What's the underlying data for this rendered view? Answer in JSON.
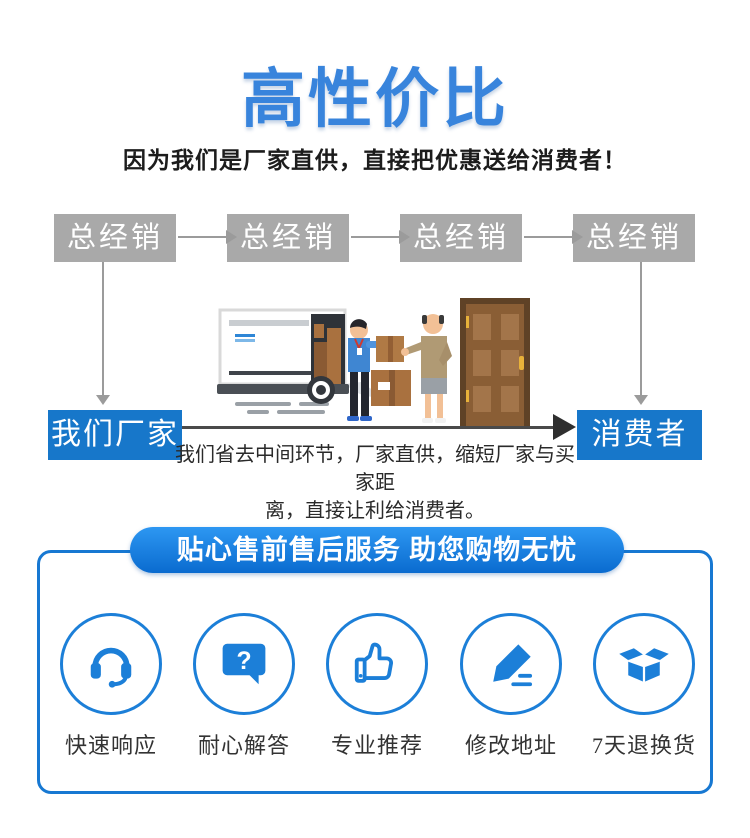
{
  "page": {
    "title": "高性价比",
    "subtitle": "因为我们是厂家直供，直接把优惠送给消费者！"
  },
  "flow": {
    "distributors": [
      "总经销",
      "总经销",
      "总经销",
      "总经销"
    ],
    "factory_label": "我们厂家",
    "consumer_label": "消费者",
    "caption_line1": "我们省去中间环节，厂家直供，缩短厂家与买家距",
    "caption_line2": "离，直接让利给消费者。"
  },
  "service": {
    "header": "贴心售前售后服务 助您购物无忧",
    "icons": {
      "question_glyph": "?"
    },
    "items": [
      {
        "icon": "headset-agent-icon",
        "label": "快速响应"
      },
      {
        "icon": "question-bubble-icon",
        "label": "耐心解答"
      },
      {
        "icon": "thumbs-up-icon",
        "label": "专业推荐"
      },
      {
        "icon": "pencil-edit-icon",
        "label": "修改地址"
      },
      {
        "icon": "open-box-icon",
        "label": "7天退换货"
      }
    ]
  },
  "colors": {
    "title_blue": "#3884dc",
    "distributor_gray": "#a9a9a9",
    "flow_box_blue": "#1777ca",
    "service_blue": "#1c7fd8",
    "pill_gradient_top": "#2d97f2",
    "pill_gradient_bottom": "#0a6bcf",
    "ground_line_dark": "#4a4a4a"
  }
}
